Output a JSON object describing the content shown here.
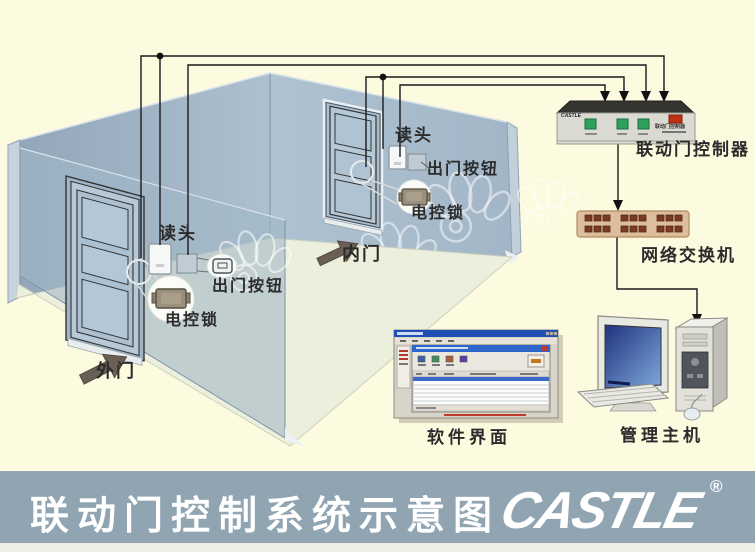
{
  "banner": {
    "title": "联动门控制系统示意图",
    "logo_text": "CASTLE",
    "registered_mark": "®"
  },
  "room": {
    "outer_door": {
      "door_label": "外门",
      "reader": "读头",
      "exit_button": "出门按钮",
      "electric_lock": "电控锁"
    },
    "inner_door": {
      "door_label": "内门",
      "reader": "读头",
      "exit_button": "出门按钮",
      "electric_lock": "电控锁"
    }
  },
  "equipment": {
    "controller": {
      "label": "联动门控制器",
      "brand": "CASTLE",
      "faceplate_label": "联动门控制器"
    },
    "network_switch": {
      "label": "网络交换机"
    },
    "software": {
      "label": "软件界面"
    },
    "management_host": {
      "label": "管理主机"
    }
  },
  "colors": {
    "background": "#FCFADF",
    "banner": "#90A4B2",
    "wall": "#A9BDCD",
    "wire": "#1A1A1A",
    "controller_button_green": "#2EA05A",
    "controller_indicator_red": "#C03010",
    "switch_body": "#DCBE9C"
  }
}
